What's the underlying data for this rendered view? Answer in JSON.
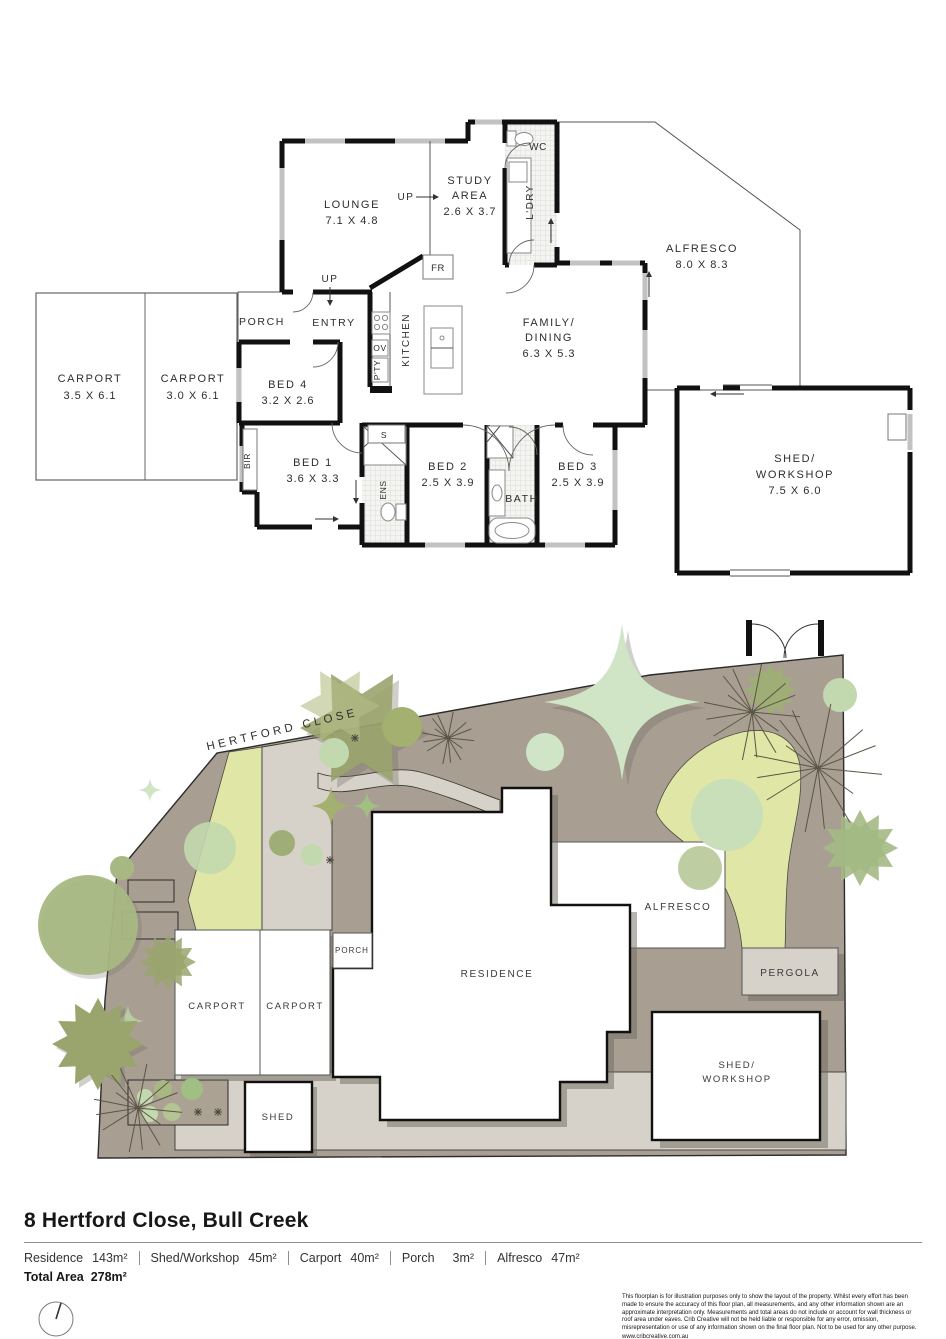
{
  "floor_plan": {
    "lounge": {
      "name": "LOUNGE",
      "dims": "7.1 X 4.8"
    },
    "study": {
      "l1": "STUDY",
      "l2": "AREA",
      "dims": "2.6 X 3.7"
    },
    "wc": "WC",
    "ldry": "L'DRY",
    "alfresco": {
      "name": "ALFRESCO",
      "dims": "8.0 X 8.3"
    },
    "porch": "PORCH",
    "entry": "ENTRY",
    "up1": "UP",
    "up2": "UP",
    "fr": "FR",
    "ov": "OV",
    "pty": "P'TY",
    "kitchen": "KITCHEN",
    "family": {
      "l1": "FAMILY/",
      "l2": "DINING",
      "dims": "6.3 X 5.3"
    },
    "carport1": {
      "name": "CARPORT",
      "dims": "3.5 X 6.1"
    },
    "carport2": {
      "name": "CARPORT",
      "dims": "3.0 X 6.1"
    },
    "bed4": {
      "name": "BED 4",
      "dims": "3.2 X 2.6"
    },
    "bir": "BIR",
    "bed1": {
      "name": "BED 1",
      "dims": "3.6 X 3.3"
    },
    "s": "S",
    "ens": "ENS",
    "bed2": {
      "name": "BED 2",
      "dims": "2.5 X 3.9"
    },
    "bath": "BATH",
    "bed3": {
      "name": "BED 3",
      "dims": "2.5 X 3.9"
    },
    "shed": {
      "l1": "SHED/",
      "l2": "WORKSHOP",
      "dims": "7.5 X 6.0"
    }
  },
  "site_plan": {
    "street": "HERTFORD CLOSE",
    "residence": "RESIDENCE",
    "alfresco": "ALFRESCO",
    "pergola": "PERGOLA",
    "porch": "PORCH",
    "carport1": "CARPORT",
    "carport2": "CARPORT",
    "shed": "SHED",
    "shed_workshop_l1": "SHED/",
    "shed_workshop_l2": "WORKSHOP"
  },
  "footer": {
    "title": "8 Hertford Close, Bull Creek",
    "areas": [
      {
        "label": "Residence",
        "value": "143m²"
      },
      {
        "label": "Shed/Workshop",
        "value": "45m²"
      },
      {
        "label": "Carport",
        "value": "40m²"
      },
      {
        "label": "Porch",
        "value": "3m²"
      },
      {
        "label": "Alfresco",
        "value": "47m²"
      }
    ],
    "total_label": "Total Area",
    "total_value": "278m²",
    "disclaimer": "This floorplan is for illustration purposes only to show the layout of the property. Whilst every effort has been made to ensure the accuracy of this floor plan, all measurements, and any other information shown are an approximate interpretation only. Measurements and total areas do not include or account for wall thickness or roof area under eaves. Crib Creative will not be held liable or responsible for any error, omission, misrepresentation or use of any information shown on the final floor plan. Not to be used for any other purpose.",
    "website": "www.cribcreative.com.au"
  },
  "colors": {
    "wall": "#111111",
    "ground": "#a89f92",
    "lawn": "#dfe6a6",
    "paving": "#d6d2c9",
    "tree_olive": "#9aa46d",
    "tree_light": "#cfe5c6",
    "tree_sage": "#c2d8ae",
    "shadow": "#6f6a60"
  }
}
